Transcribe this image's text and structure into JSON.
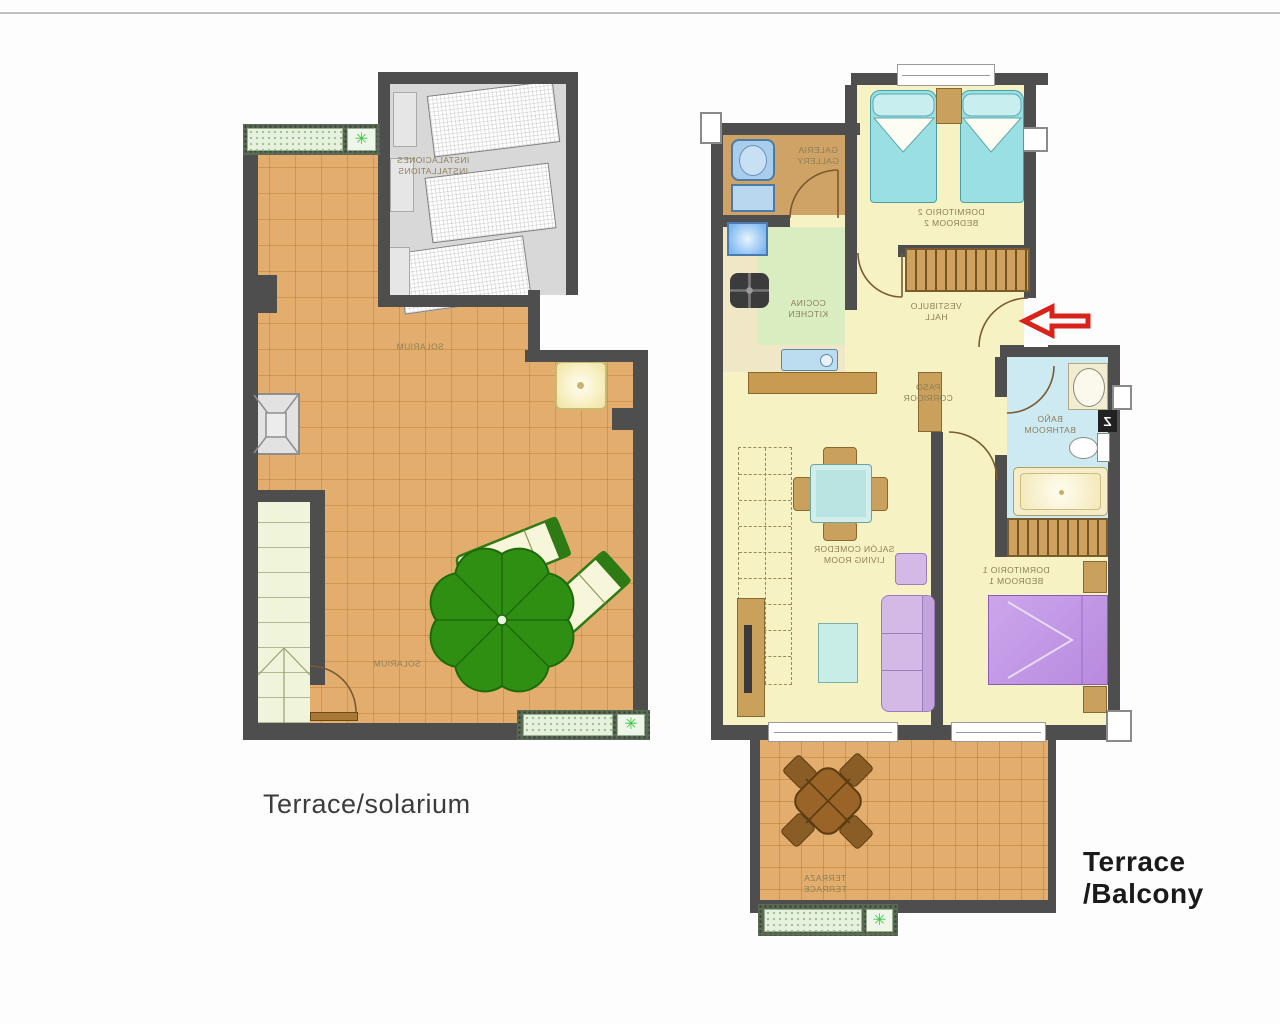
{
  "captions": {
    "left": "Terrace/solarium",
    "right": "Terrace /Balcony"
  },
  "floor_left": {
    "title": "terrace-solarium-level",
    "labels": {
      "installations": "INSTALACIONES\nINSTALLATIONS",
      "solarium_upper": "SOLARIUM",
      "solarium_lower": "SOLARIUM"
    }
  },
  "floor_right": {
    "title": "apartment-level",
    "labels": {
      "gallery": "GALERIA\nGALLERY",
      "kitchen": "COCINA\nKITCHEN",
      "bedroom2": "DORMITORIO 2\nBEDROOM 2",
      "hall": "VESTIBULO\nHALL",
      "corridor": "PASO\nCORRIDOR",
      "bathroom": "BAÑO\nBATHROOM",
      "living": "SALÓN COMEDOR\nLIVING ROOM",
      "bedroom1": "DORMITORIO 1\nBEDROOM 1",
      "terrace": "TERRAZA\nTERRACE",
      "boiler": "Z"
    }
  },
  "colors": {
    "wall": "#4e4e4e",
    "terrace_orange": "#e3ae6d",
    "room_yellow": "#f7f2c4",
    "kitchen_green": "#d9edc1",
    "bathroom_blue": "#cde9f1",
    "umbrella_green": "#2f8f12",
    "bed_cyan": "#9adfe2",
    "bed_purple": "#bf94e4",
    "sofa_lavender": "#d4b9e7",
    "arrow_red": "#d8231d"
  }
}
